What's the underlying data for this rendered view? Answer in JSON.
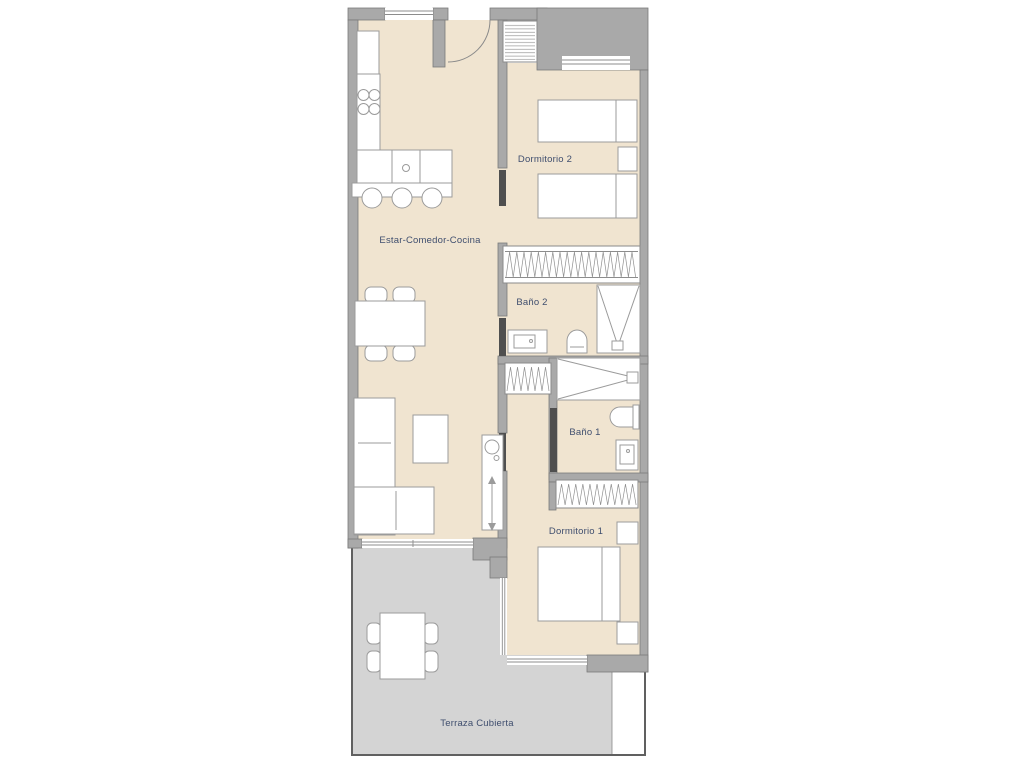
{
  "floor_plan": {
    "labels": {
      "living_kitchen": "Estar-Comedor-Cocina",
      "bedroom2": "Dormitorio 2",
      "bath2": "Baño 2",
      "bath1": "Baño 1",
      "bedroom1": "Dormitorio 1",
      "terrace": "Terraza Cubierta"
    },
    "colors": {
      "interior_floor": "#f0e4d0",
      "terrace_floor": "#d4d4d4",
      "wall_fill": "#a9a9a9",
      "wall_outline": "#7a7a7a",
      "sliding_door": "#4f4f4f",
      "furniture_outline": "#9b9b9b",
      "label_text": "#3f4e6e",
      "background": "#ffffff"
    }
  }
}
